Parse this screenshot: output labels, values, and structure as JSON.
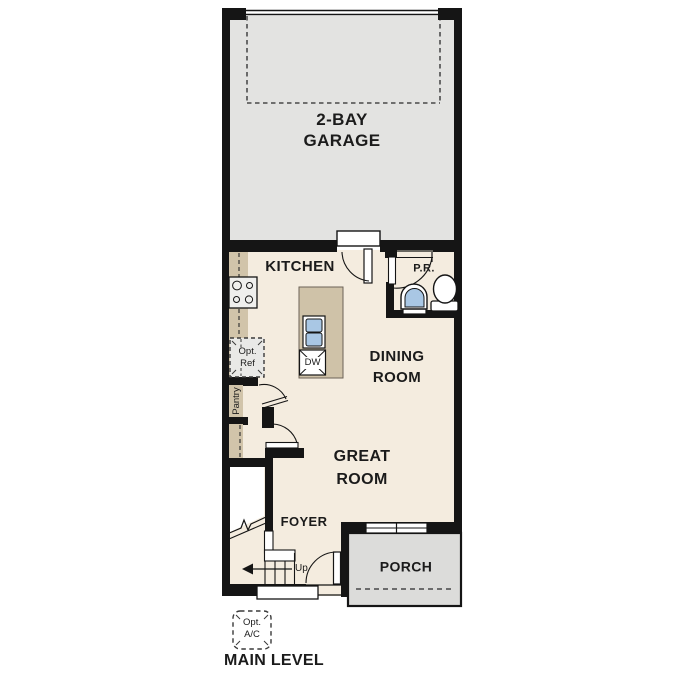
{
  "title": "MAIN LEVEL",
  "rooms": {
    "garage": {
      "label_line1": "2-BAY",
      "label_line2": "GARAGE"
    },
    "kitchen": {
      "label": "KITCHEN"
    },
    "powder_room": {
      "label": "P.R."
    },
    "dining": {
      "label_line1": "DINING",
      "label_line2": "ROOM"
    },
    "great_room": {
      "label_line1": "GREAT",
      "label_line2": "ROOM"
    },
    "foyer": {
      "label": "FOYER"
    },
    "porch": {
      "label": "PORCH"
    }
  },
  "annotations": {
    "stairs_direction": "Up",
    "dishwasher": "DW",
    "optional_refrigerator_line1": "Opt.",
    "optional_refrigerator_line2": "Ref",
    "pantry": "Pantry",
    "optional_ac_line1": "Opt.",
    "optional_ac_line2": "A/C"
  },
  "colors": {
    "wall": "#151515",
    "interior_floor": "#f4ecdf",
    "garage_floor": "#e3e3e1",
    "porch_floor": "#dcdcda",
    "counter_tan": "#d1c4aa",
    "fixture_blue": "#a9c7e4",
    "optional_box_fill": "#e9e9e7",
    "text": "#1b1b1b"
  }
}
